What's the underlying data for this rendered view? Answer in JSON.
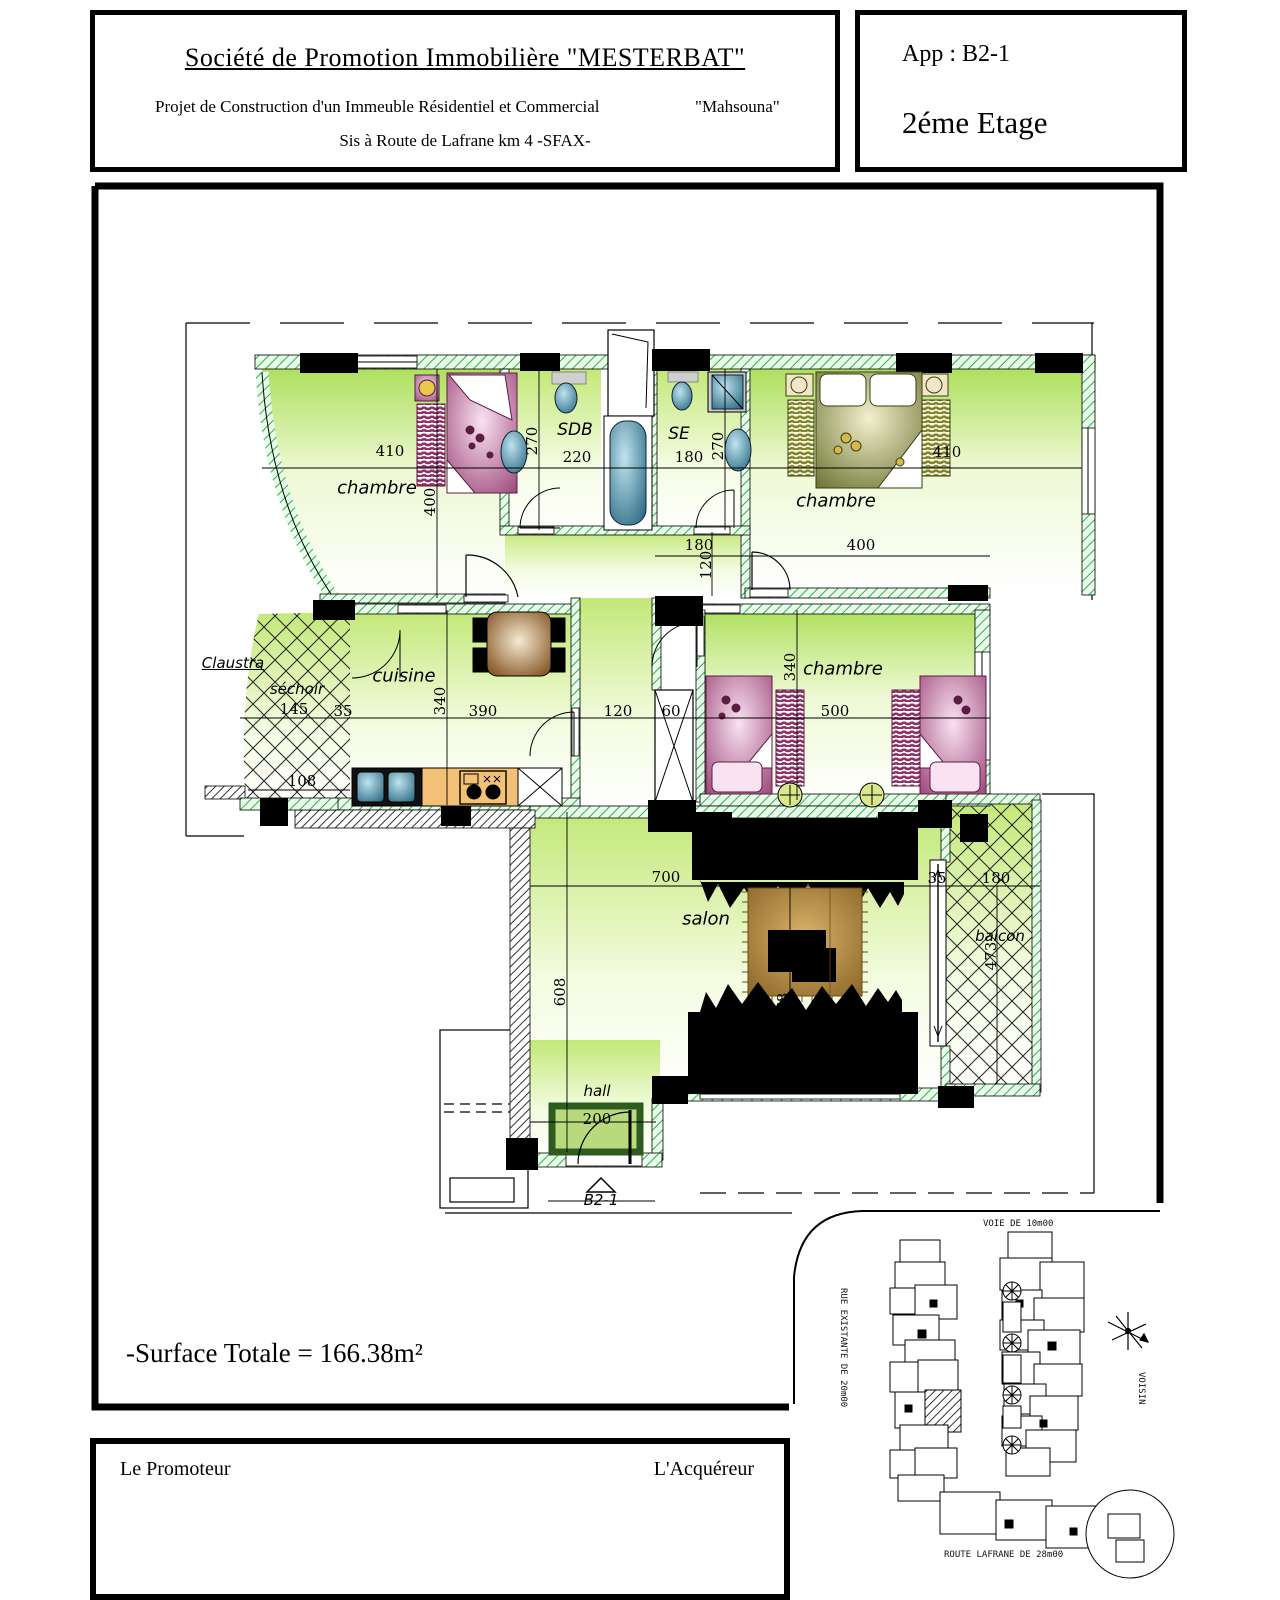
{
  "header": {
    "company": "Société de Promotion Immobilière \"MESTERBAT\"",
    "project": "Projet de Construction d'un Immeuble Résidentiel et Commercial",
    "project_name": "\"Mahsouna\"",
    "address": "Sis à Route de Lafrane km 4  -SFAX-",
    "app_label": "App :   B2-1",
    "floor": "2éme Etage"
  },
  "plan": {
    "rooms": {
      "ch1": "chambre",
      "sdb": "SDB",
      "se": "SE",
      "ch2": "chambre",
      "ch3": "chambre",
      "cuisine": "cuisine",
      "sechoir": "séchoir",
      "claustra": "Claustra",
      "salon": "salon",
      "hall": "hall",
      "balcon": "balcon"
    },
    "entry_label": "B2-1",
    "dims": {
      "d410a": "410",
      "d400a": "400",
      "d270a": "270",
      "d220": "220",
      "d180a": "180",
      "d270b": "270",
      "d410b": "410",
      "d180b": "180",
      "d400b": "400",
      "d120v": "120",
      "d145": "145",
      "d35a": "35",
      "d108": "108",
      "d340a": "340",
      "d390": "390",
      "d120": "120",
      "d60": "60",
      "d340b": "340",
      "d500": "500",
      "d700": "700",
      "d35b": "35",
      "d180c": "180",
      "d608": "608",
      "d478": "478",
      "d473": "473",
      "d200": "200"
    }
  },
  "summary": {
    "surface": "-Surface Totale = 166.38m²"
  },
  "footer": {
    "promoter": "Le Promoteur",
    "buyer": "L'Acquéreur"
  },
  "site_plan": {
    "top_road": "VOIE DE 10m00",
    "left_road": "RUE EXISTANTE DE 20m00",
    "right_label": "VOISIN",
    "bottom_road": "ROUTE LAFRANE   DE  28m00",
    "north_icon": "north-compass"
  },
  "colors": {
    "wall_green": "#2fae4e",
    "room_green": "#b5e06a",
    "furniture_magenta": "#8e2f66",
    "bed_olive": "#5f6a1e",
    "fixture_teal": "#2c6b84",
    "counter_orange": "#f3c078",
    "carpet_brown": "#8a6426",
    "mat_green": "#2e5c1e"
  }
}
